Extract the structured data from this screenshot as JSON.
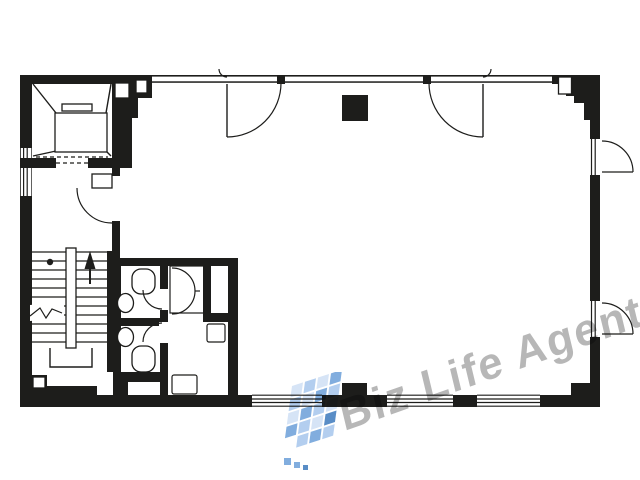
{
  "watermark": {
    "text": "Biz Life Agent",
    "logo_name": "blue-mosaic-logo"
  },
  "colors": {
    "background": "#ffffff",
    "wall": "#1d1d1b",
    "watermark_text": "#8a8a8a",
    "logo_light": "#cfe0f5",
    "logo_mid": "#a6c6ec",
    "logo_deep": "#6b9fd8",
    "logo_dark": "#3b79bc"
  }
}
